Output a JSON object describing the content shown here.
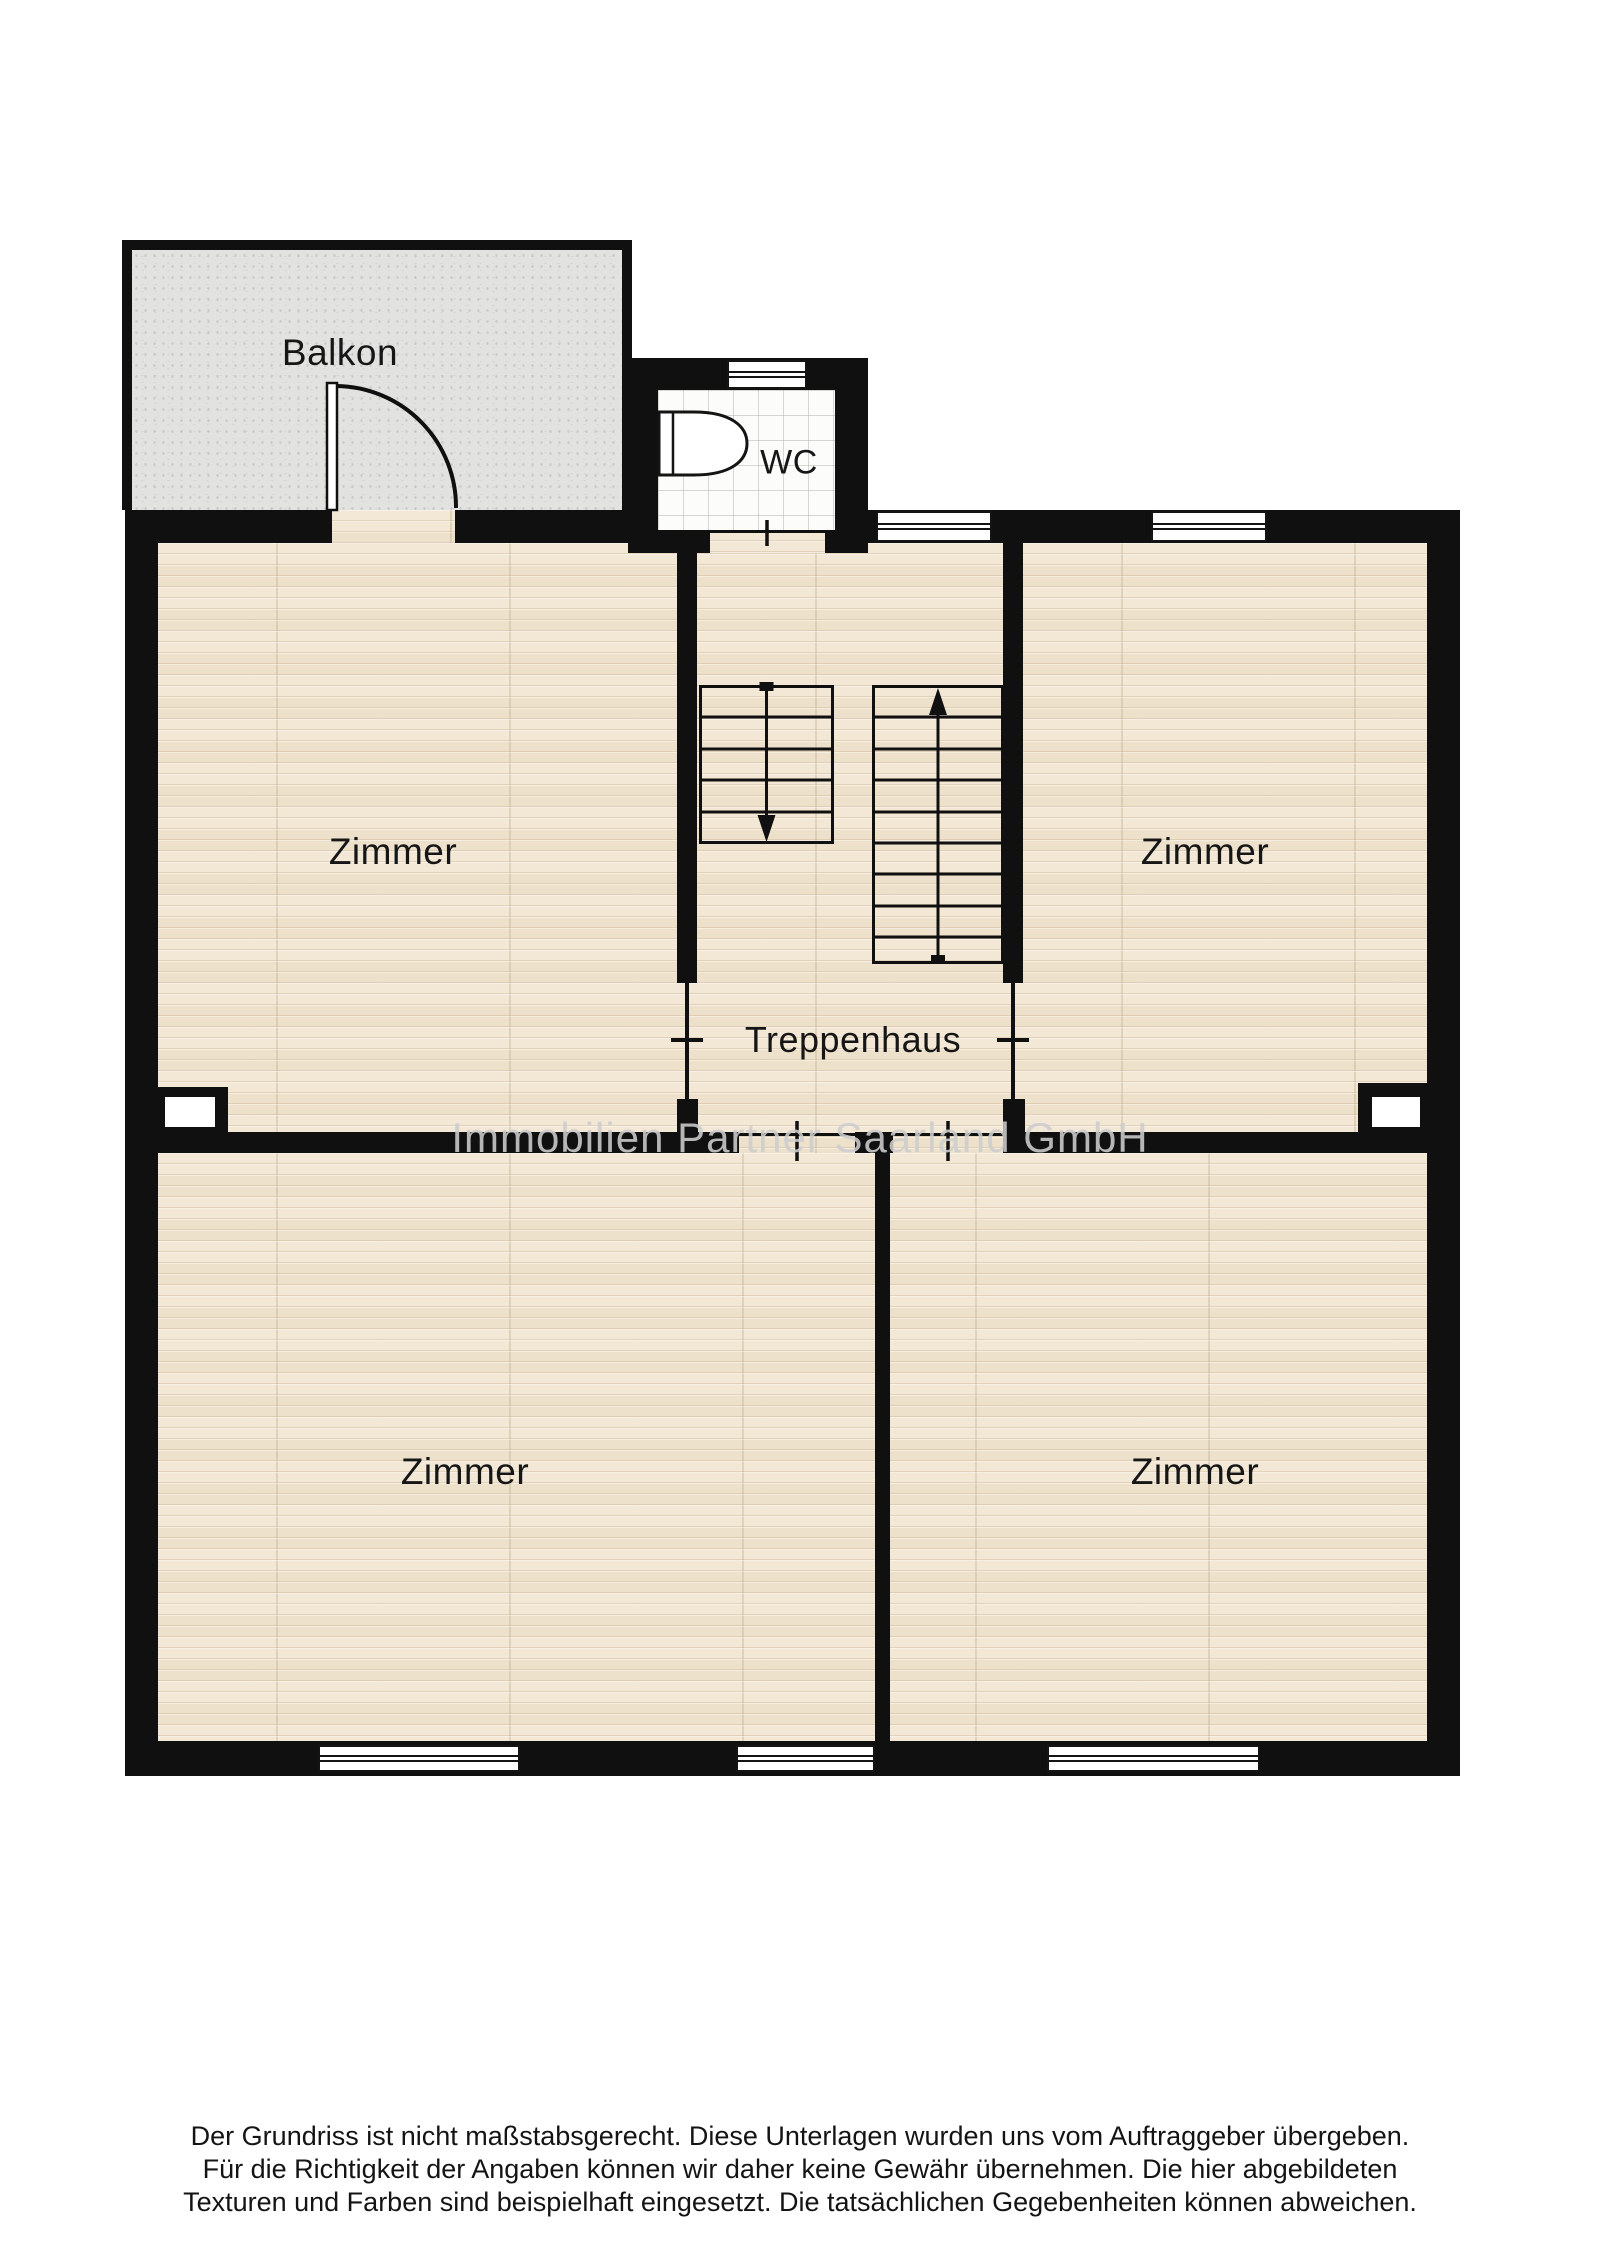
{
  "plan": {
    "rooms": {
      "balkon": {
        "label": "Balkon"
      },
      "wc": {
        "label": "WC"
      },
      "zimmer_top_left": {
        "label": "Zimmer"
      },
      "zimmer_top_right": {
        "label": "Zimmer"
      },
      "treppenhaus": {
        "label": "Treppenhaus"
      },
      "zimmer_bottom_left": {
        "label": "Zimmer"
      },
      "zimmer_bottom_right": {
        "label": "Zimmer"
      }
    },
    "stairs": {
      "left_flight": {
        "direction": "down",
        "steps": 5
      },
      "right_flight": {
        "direction": "up",
        "steps": 9
      }
    },
    "watermark": "Immobilien Partner Saarland GmbH",
    "disclaimer": [
      "Der Grundriss ist nicht maßstabsgerecht. Diese Unterlagen wurden uns vom Auftraggeber übergeben.",
      "Für die Richtigkeit der Angaben können wir daher keine Gewähr übernehmen. Die hier abgebildeten",
      "Texturen und Farben sind beispielhaft eingesetzt. Die tatsächlichen Gegebenheiten können abweichen."
    ],
    "colors": {
      "wall": "#101010",
      "wood_floor": "#f1e5d2",
      "balcony_floor": "#e2e2e0",
      "tile_floor": "#fcfcfb",
      "label": "#161616",
      "watermark": "#cdcdcd"
    }
  }
}
